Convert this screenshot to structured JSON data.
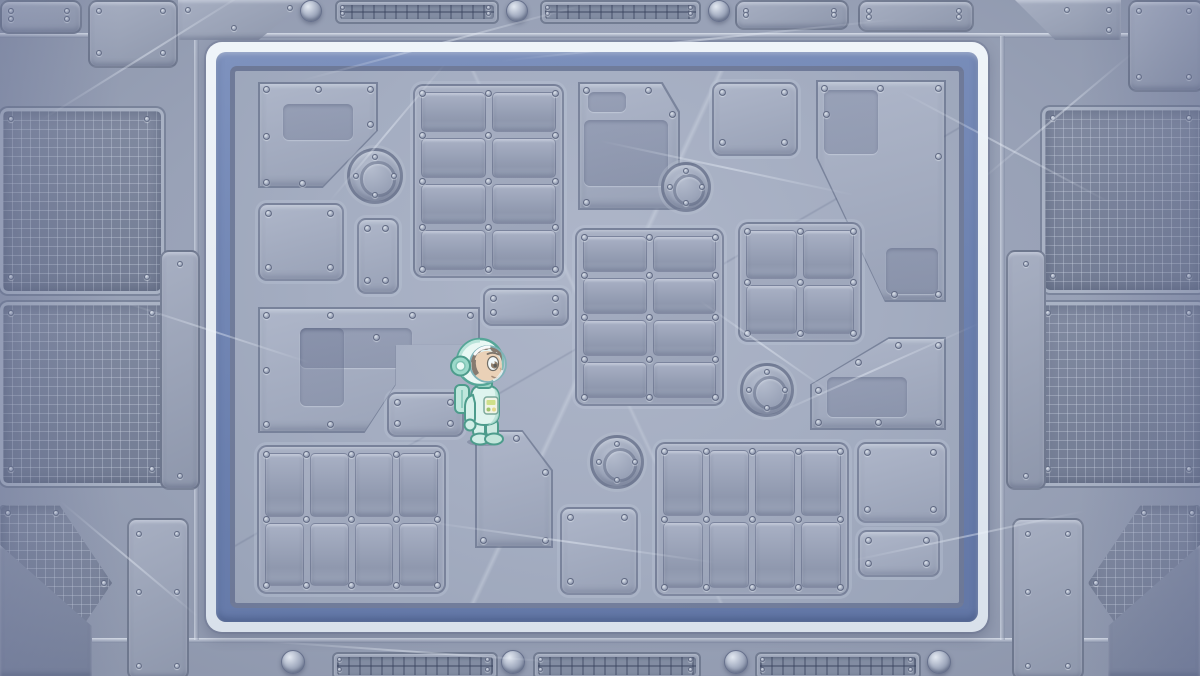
{
  "scene": {
    "name": "space-station-deck",
    "type": "game-level",
    "description": "Top-down metal space-station floor framed by a blue-and-white bordered play area; a kid astronaut in a mint spacesuit stands left of center facing right.",
    "width": 1200,
    "height": 676
  },
  "palette": {
    "metal_base": "#99a2b7",
    "metal_dark": "#8b94aa",
    "metal_light": "#aab3c6",
    "board_white_band": "#e7edf3",
    "board_blue_band": "#7086b3",
    "board_inner_edge": "#5c6d99",
    "floor": "#a6aec2",
    "panel_edge": "#56607c",
    "rivet_light": "#d9dfe9",
    "rivet_dark": "#7f89a0",
    "suit_mint": "#d6f1ea",
    "suit_accent": "#4d9c8c"
  },
  "character": {
    "id": "astronaut",
    "label": "astronaut kid in mint space suit",
    "x": 450,
    "y": 335,
    "width": 66,
    "height": 112,
    "facing": "right",
    "expression": "smiling",
    "suit_color": "#d6f1ea",
    "skin_color": "#f4c498",
    "hair_color": "#5d3f2b"
  },
  "board": {
    "x": 206,
    "y": 42,
    "w": 782,
    "h": 590
  },
  "floor_panels": [
    {
      "id": "panel-top-left-pentagon",
      "type": "poly",
      "x": 258,
      "y": 82,
      "w": 120,
      "h": 106,
      "clip": "polygon(0% 0%,100% 0%,100% 46%,54% 100%,0% 100%)",
      "rivets": [
        [
          8,
          7
        ],
        [
          60,
          7
        ],
        [
          112,
          7
        ],
        [
          112,
          42
        ],
        [
          8,
          54
        ],
        [
          8,
          100
        ],
        [
          44,
          101
        ]
      ],
      "inner": [
        [
          25,
          22,
          70,
          36
        ]
      ]
    },
    {
      "id": "panel-grid-top",
      "type": "grid",
      "x": 413,
      "y": 84,
      "w": 147,
      "h": 190,
      "cols": 2,
      "rows": 4
    },
    {
      "id": "panel-mid-pentagon",
      "type": "poly",
      "x": 578,
      "y": 82,
      "w": 102,
      "h": 128,
      "clip": "polygon(0% 0%,83% 0%,100% 23%,100% 100%,0% 100%)",
      "rivets": [
        [
          8,
          8
        ],
        [
          70,
          8
        ],
        [
          94,
          32
        ],
        [
          94,
          120
        ],
        [
          8,
          120
        ]
      ],
      "inner": [
        [
          10,
          10,
          38,
          20
        ],
        [
          6,
          38,
          84,
          66
        ]
      ]
    },
    {
      "id": "panel-square-top",
      "type": "rect",
      "x": 712,
      "y": 82,
      "w": 82,
      "h": 70
    },
    {
      "id": "panel-top-right-poly",
      "type": "poly",
      "x": 816,
      "y": 80,
      "w": 130,
      "h": 222,
      "clip": "polygon(0% 0%,100% 0%,100% 100%,53% 100%,0% 35%)",
      "rivets": [
        [
          8,
          8
        ],
        [
          64,
          8
        ],
        [
          122,
          8
        ],
        [
          122,
          76
        ],
        [
          122,
          214
        ],
        [
          78,
          214
        ],
        [
          10,
          34
        ]
      ],
      "inner": [
        [
          8,
          10,
          54,
          64
        ],
        [
          70,
          168,
          52,
          46
        ]
      ]
    },
    {
      "id": "panel-square-left",
      "type": "rect",
      "x": 258,
      "y": 203,
      "w": 82,
      "h": 74
    },
    {
      "id": "panel-small-left",
      "type": "rect",
      "x": 357,
      "y": 218,
      "w": 38,
      "h": 72
    },
    {
      "id": "panel-l-shape",
      "type": "poly",
      "x": 258,
      "y": 307,
      "w": 222,
      "h": 126,
      "clip": "polygon(0% 0%,100% 0%,100% 30%,62% 30%,62% 62%,48% 100%,0% 100%)",
      "rivets": [
        [
          8,
          8
        ],
        [
          72,
          8
        ],
        [
          154,
          8
        ],
        [
          212,
          8
        ],
        [
          8,
          63
        ],
        [
          8,
          117
        ],
        [
          72,
          117
        ],
        [
          118,
          30
        ]
      ],
      "inner": [
        [
          42,
          21,
          112,
          40
        ],
        [
          42,
          21,
          44,
          78
        ]
      ]
    },
    {
      "id": "panel-wide-small",
      "type": "rect",
      "x": 483,
      "y": 288,
      "w": 82,
      "h": 34
    },
    {
      "id": "panel-below-character",
      "type": "rect",
      "x": 387,
      "y": 392,
      "w": 73,
      "h": 41
    },
    {
      "id": "panel-grid-center",
      "type": "grid",
      "x": 575,
      "y": 228,
      "w": 145,
      "h": 174,
      "cols": 2,
      "rows": 4
    },
    {
      "id": "panel-grid-2x2",
      "type": "grid",
      "x": 738,
      "y": 222,
      "w": 120,
      "h": 116,
      "cols": 2,
      "rows": 2
    },
    {
      "id": "panel-right-lower-poly",
      "type": "poly",
      "x": 810,
      "y": 337,
      "w": 136,
      "h": 93,
      "clip": "polygon(0% 100%,0% 51%,58% 0%,100% 0%,100% 100%)",
      "rivets": [
        [
          8,
          53
        ],
        [
          48,
          25
        ],
        [
          88,
          8
        ],
        [
          128,
          8
        ],
        [
          128,
          85
        ],
        [
          8,
          85
        ],
        [
          68,
          85
        ]
      ],
      "inner": [
        [
          17,
          40,
          80,
          40
        ]
      ]
    },
    {
      "id": "panel-grid-bottom-left",
      "type": "grid",
      "x": 257,
      "y": 445,
      "w": 185,
      "h": 145,
      "cols": 4,
      "rows": 2
    },
    {
      "id": "panel-trapezoid",
      "type": "poly",
      "x": 475,
      "y": 430,
      "w": 78,
      "h": 118,
      "clip": "polygon(0% 0%,61% 0%,100% 34%,100% 100%,0% 100%)",
      "rivets": [
        [
          8,
          8
        ],
        [
          41,
          8
        ],
        [
          70,
          42
        ],
        [
          70,
          110
        ],
        [
          8,
          110
        ]
      ]
    },
    {
      "id": "panel-square-bottom",
      "type": "rect",
      "x": 560,
      "y": 507,
      "w": 74,
      "h": 84
    },
    {
      "id": "panel-grid-bottom-right",
      "type": "grid",
      "x": 655,
      "y": 442,
      "w": 190,
      "h": 150,
      "cols": 4,
      "rows": 2
    },
    {
      "id": "panel-square-br",
      "type": "rect",
      "x": 857,
      "y": 442,
      "w": 86,
      "h": 77
    },
    {
      "id": "panel-small-br",
      "type": "rect",
      "x": 858,
      "y": 530,
      "w": 78,
      "h": 43
    }
  ],
  "hatches": [
    {
      "cx": 375,
      "cy": 176,
      "r": 28
    },
    {
      "cx": 686,
      "cy": 187,
      "r": 25
    },
    {
      "cx": 767,
      "cy": 390,
      "r": 27
    },
    {
      "cx": 617,
      "cy": 462,
      "r": 27
    }
  ],
  "outer": {
    "meshes": [
      {
        "x": 0,
        "y": 108,
        "w": 158,
        "h": 180
      },
      {
        "x": 0,
        "y": 302,
        "w": 163,
        "h": 178
      },
      {
        "x": 0,
        "y": 505,
        "w": 112,
        "h": 156,
        "clip": "polygon(0% 0%,53% 0%,100% 50%,53% 100%,0% 100%)",
        "rivets": [
          [
            8,
            8
          ],
          [
            56,
            8
          ],
          [
            104,
            78
          ],
          [
            56,
            148
          ],
          [
            8,
            148
          ]
        ]
      },
      {
        "x": 1042,
        "y": 107,
        "w": 158,
        "h": 180
      },
      {
        "x": 1037,
        "y": 302,
        "w": 163,
        "h": 178
      },
      {
        "x": 1088,
        "y": 505,
        "w": 112,
        "h": 156,
        "clip": "polygon(100% 0%,47% 0%,0% 50%,47% 100%,100% 100%)",
        "rivets": [
          [
            104,
            8
          ],
          [
            56,
            8
          ],
          [
            8,
            78
          ],
          [
            56,
            148
          ],
          [
            104,
            148
          ]
        ]
      }
    ],
    "plates": [
      {
        "x": 0,
        "y": 0,
        "w": 78,
        "h": 30
      },
      {
        "x": 88,
        "y": 0,
        "w": 86,
        "h": 64
      },
      {
        "x": 178,
        "y": 0,
        "w": 130,
        "h": 40,
        "clip": "polygon(0% 0%,100% 0%,62% 100%,0% 100%)",
        "rivets": [
          [
            10,
            10
          ],
          [
            112,
            8
          ],
          [
            56,
            28
          ]
        ]
      },
      {
        "x": 735,
        "y": 0,
        "w": 110,
        "h": 26
      },
      {
        "x": 858,
        "y": 0,
        "w": 112,
        "h": 28
      },
      {
        "x": 1128,
        "y": 0,
        "w": 72,
        "h": 88
      },
      {
        "x": 1015,
        "y": 0,
        "w": 106,
        "h": 40,
        "clip": "polygon(0% 0%,100% 0%,100% 100%,38% 100%)",
        "rivets": [
          [
            94,
            10
          ],
          [
            52,
            10
          ],
          [
            94,
            30
          ]
        ]
      },
      {
        "x": 127,
        "y": 518,
        "w": 58,
        "h": 158,
        "rivets": [
          [
            10,
            14
          ],
          [
            48,
            14
          ],
          [
            10,
            72
          ],
          [
            48,
            72
          ],
          [
            10,
            146
          ],
          [
            48,
            146
          ]
        ]
      },
      {
        "x": 1012,
        "y": 518,
        "w": 68,
        "h": 158,
        "rivets": [
          [
            14,
            14
          ],
          [
            54,
            14
          ],
          [
            14,
            72
          ],
          [
            54,
            72
          ],
          [
            14,
            146
          ],
          [
            54,
            146
          ]
        ]
      },
      {
        "x": 160,
        "y": 250,
        "w": 36,
        "h": 236,
        "rivets": [
          [
            18,
            12
          ],
          [
            18,
            224
          ]
        ]
      },
      {
        "x": 1006,
        "y": 250,
        "w": 36,
        "h": 236,
        "rivets": [
          [
            18,
            12
          ],
          [
            18,
            224
          ]
        ]
      },
      {
        "x": 0,
        "y": 545,
        "w": 92,
        "h": 131,
        "clip": "polygon(0% 0%,100% 62%,100% 100%,0% 100%)",
        "dark": true
      },
      {
        "x": 1108,
        "y": 545,
        "w": 92,
        "h": 131,
        "clip": "polygon(100% 0%,0% 62%,0% 100%,100% 100%)",
        "dark": true
      }
    ],
    "vents": [
      {
        "x": 335,
        "y": 0,
        "w": 160,
        "h": 20
      },
      {
        "x": 540,
        "y": 0,
        "w": 157,
        "h": 20
      },
      {
        "x": 332,
        "y": 652,
        "w": 162,
        "h": 24
      },
      {
        "x": 533,
        "y": 652,
        "w": 164,
        "h": 24
      },
      {
        "x": 755,
        "y": 652,
        "w": 162,
        "h": 24
      }
    ],
    "dome_rivets": [
      {
        "cx": 310,
        "cy": 10,
        "r": 10
      },
      {
        "cx": 516,
        "cy": 10,
        "r": 10
      },
      {
        "cx": 718,
        "cy": 10,
        "r": 10
      },
      {
        "cx": 292,
        "cy": 661,
        "r": 11
      },
      {
        "cx": 512,
        "cy": 661,
        "r": 11
      },
      {
        "cx": 735,
        "cy": 661,
        "r": 11
      },
      {
        "cx": 938,
        "cy": 661,
        "r": 11
      }
    ],
    "seams": [
      {
        "x": 0,
        "y": 33,
        "w": 1200,
        "h": 5,
        "dir": "h"
      },
      {
        "x": 0,
        "y": 638,
        "w": 1200,
        "h": 5,
        "dir": "h"
      },
      {
        "x": 194,
        "y": 36,
        "w": 5,
        "h": 604,
        "dir": "v"
      },
      {
        "x": 1000,
        "y": 36,
        "w": 5,
        "h": 604,
        "dir": "v"
      }
    ]
  }
}
